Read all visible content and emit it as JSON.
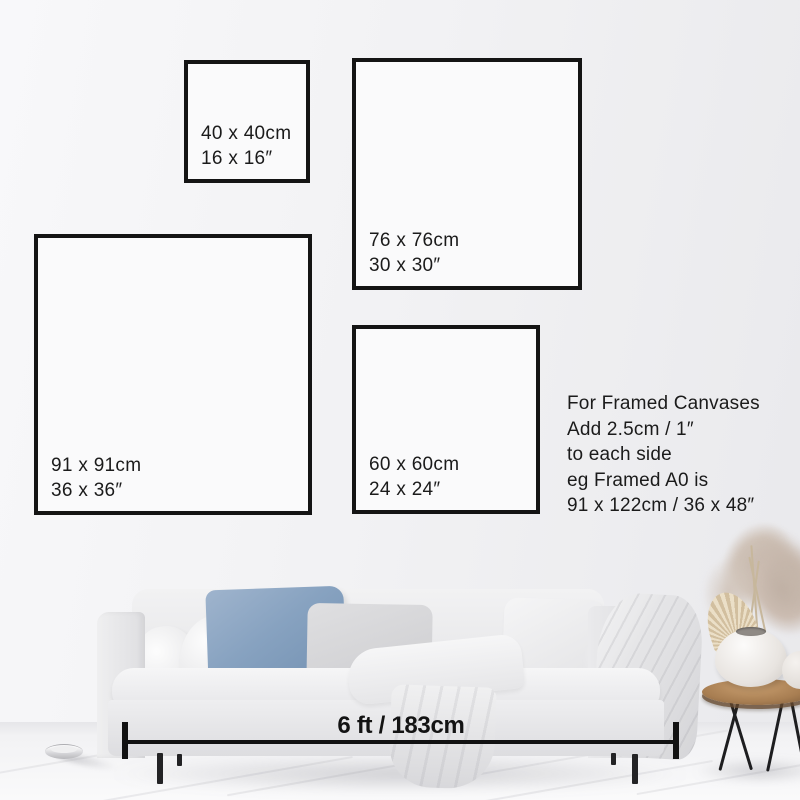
{
  "frames": [
    {
      "cm": "40 x 40cm",
      "inches": "16 x 16″"
    },
    {
      "cm": "76 x 76cm",
      "inches": "30 x 30″"
    },
    {
      "cm": "91 x 91cm",
      "inches": "36 x 36″"
    },
    {
      "cm": "60 x 60cm",
      "inches": "24 x 24″"
    }
  ],
  "note": {
    "lines": [
      "For Framed Canvases",
      "Add 2.5cm / 1″",
      "to each side",
      "eg Framed A0 is",
      "91 x 122cm / 36 x 48″"
    ]
  },
  "measurement": {
    "label": "6 ft / 183cm"
  },
  "colors": {
    "frame_border": "#141414",
    "text": "#1b1b1b",
    "wall_left": "#f8f8fa",
    "wall_right": "#e9e9ec",
    "floor": "#f2f2f4",
    "sofa": "#e8e8ea",
    "pillow_blue": "#87a2c0",
    "table_wood": "#a87e52",
    "pampas": "#cfc2b7",
    "measure_line": "#121212"
  }
}
